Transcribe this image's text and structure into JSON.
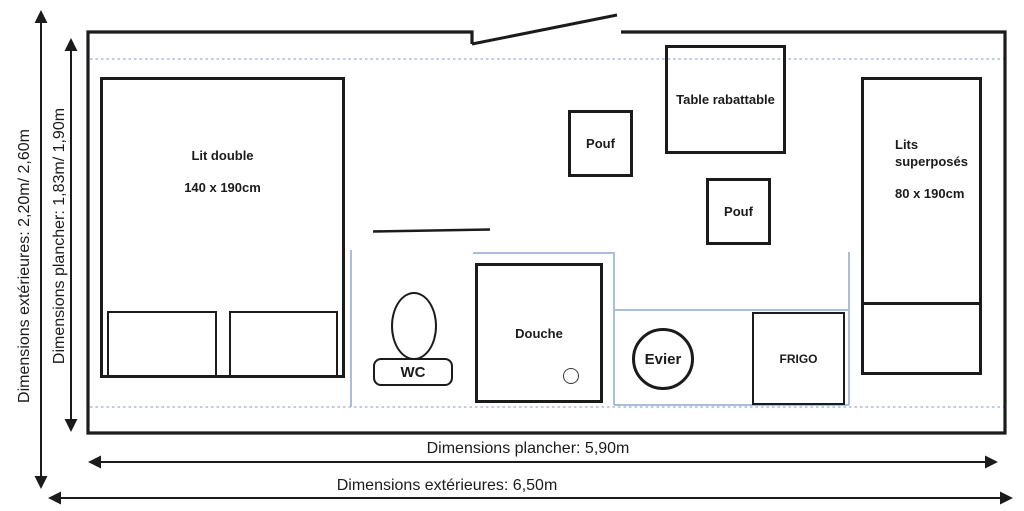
{
  "dimensions": {
    "left_outer": "Dimensions extérieures: 2,20m/ 2,60m",
    "left_inner": "Dimensions plancher: 1,83m/ 1,90m",
    "bottom_inner": "Dimensions plancher: 5,90m",
    "bottom_outer": "Dimensions extérieures: 6,50m"
  },
  "furniture": {
    "lit_double": {
      "name": "Lit double",
      "size": "140 x 190cm"
    },
    "pouf_top": {
      "name": "Pouf"
    },
    "pouf_bottom": {
      "name": "Pouf"
    },
    "table": {
      "name": "Table rabattable"
    },
    "lits_superposes": {
      "name": "Lits superposés",
      "size": "80 x 190cm"
    },
    "wc": {
      "name": "WC"
    },
    "douche": {
      "name": "Douche"
    },
    "evier": {
      "name": "Evier"
    },
    "frigo": {
      "name": "FRIGO"
    }
  },
  "colors": {
    "wall": "#1b1b1b",
    "partition_blue": "#aabdde",
    "dashed_blue": "#96add2"
  }
}
